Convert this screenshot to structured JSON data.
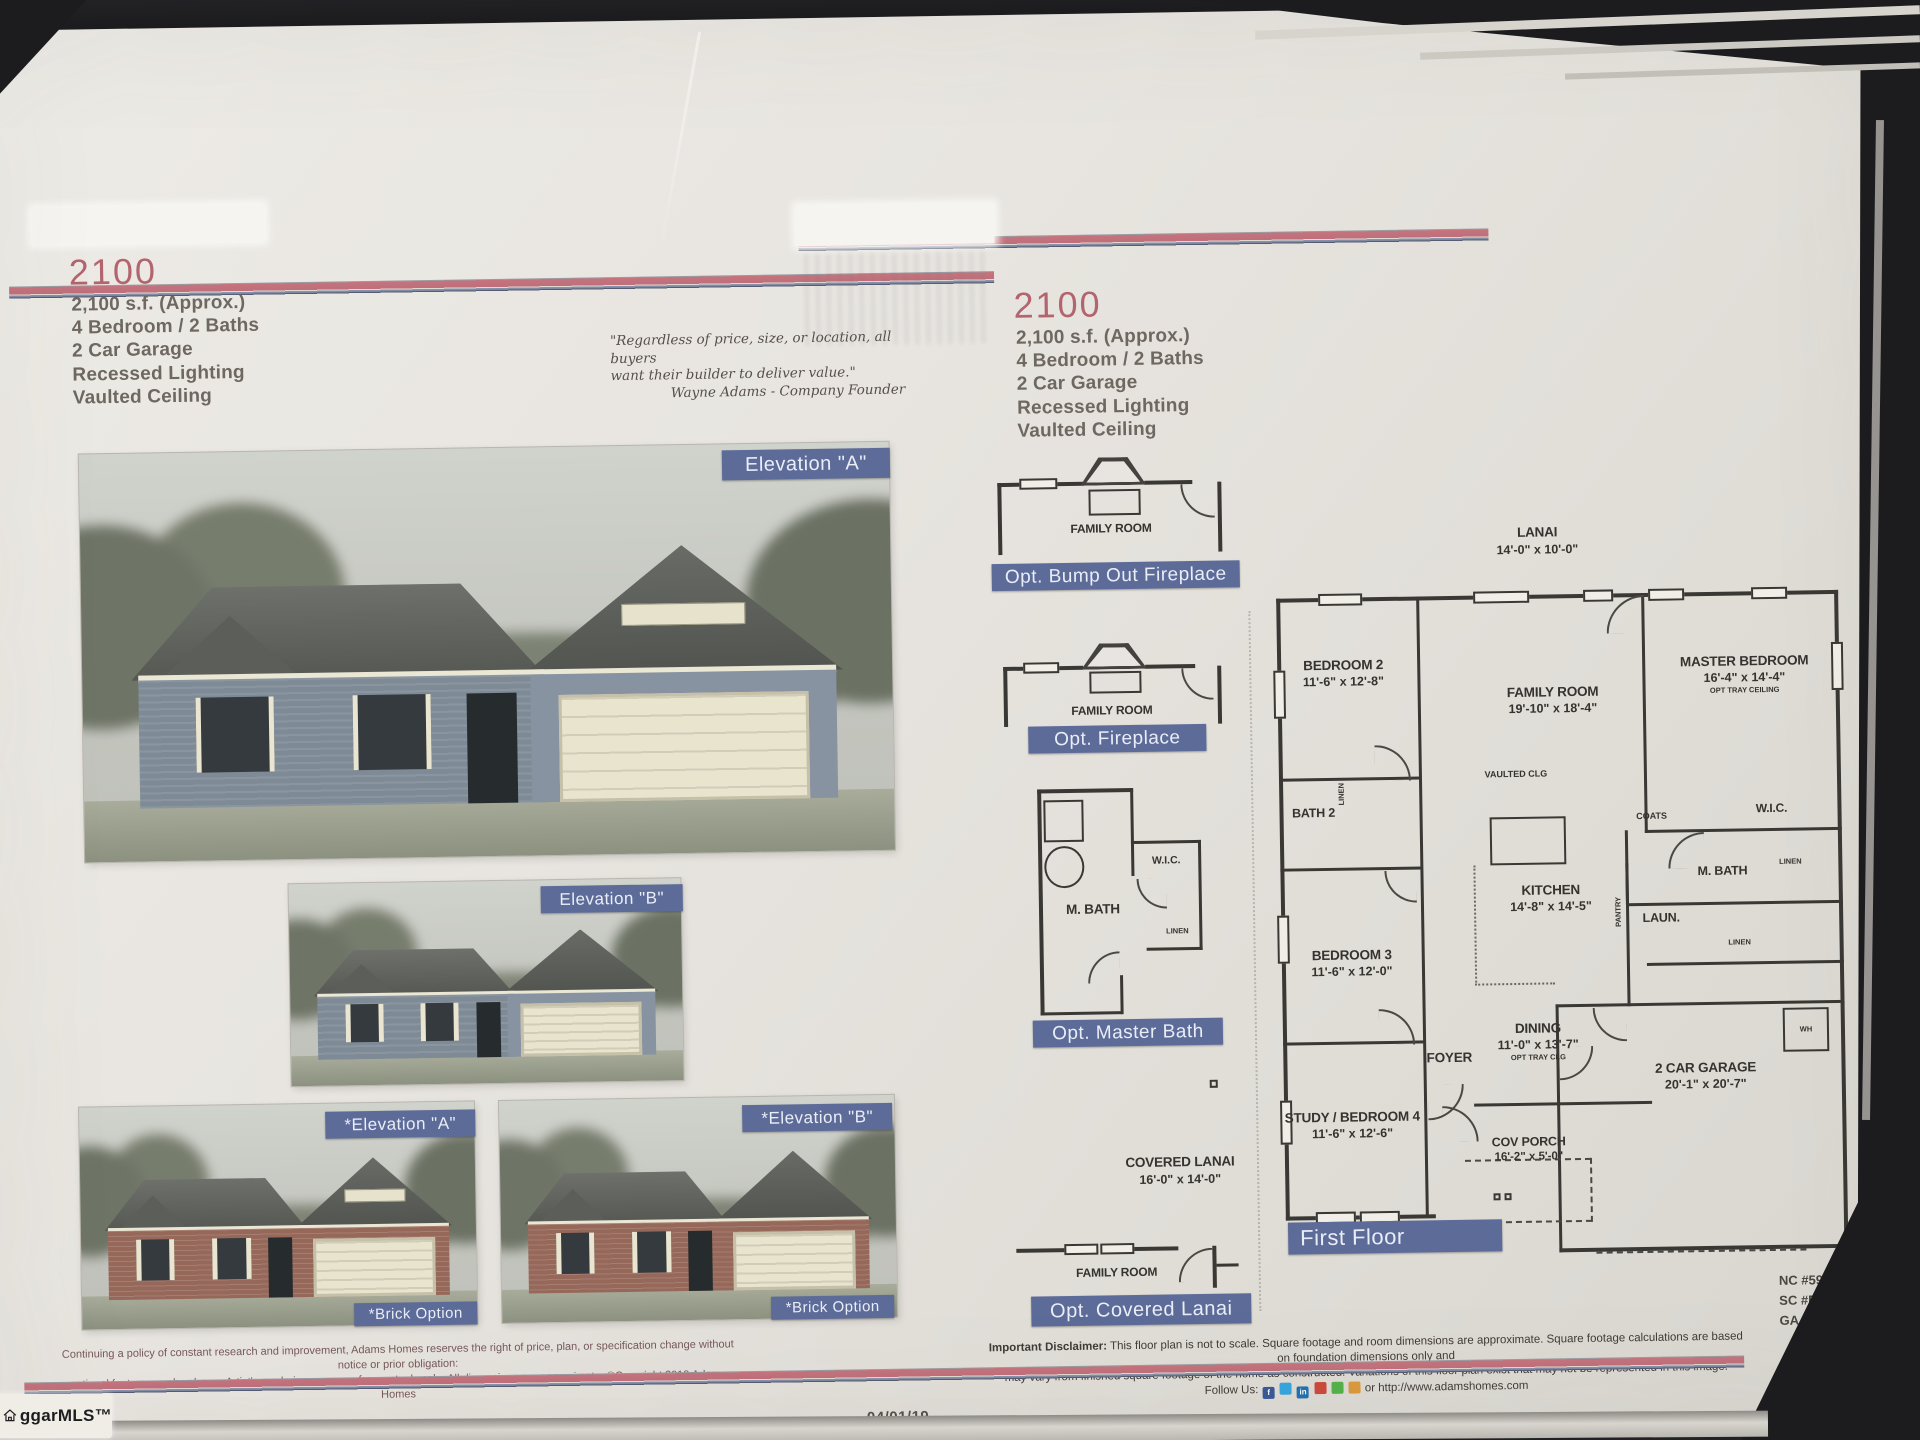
{
  "photo": {
    "watermark": "ggarMLS™",
    "date_center": "04/01/19",
    "date_right": "04/01/19"
  },
  "model": "2100",
  "specs": [
    "2,100 s.f. (Approx.)",
    "4 Bedroom / 2 Baths",
    "2 Car Garage",
    "Recessed Lighting",
    "Vaulted Ceiling"
  ],
  "quote": {
    "line1": "\"Regardless of price, size, or location, all buyers",
    "line2": "want their builder to deliver value.\"",
    "attrib": "Wayne Adams - Company Founder"
  },
  "elevations": {
    "a": "Elevation \"A\"",
    "b": "Elevation \"B\"",
    "a_brick": "*Elevation \"A\"",
    "b_brick": "*Elevation \"B\"",
    "brick_caption": "*Brick Option"
  },
  "options": {
    "bump_room": "FAMILY ROOM",
    "bump_label": "Opt. Bump Out Fireplace",
    "fp_room": "FAMILY ROOM",
    "fp_label": "Opt. Fireplace",
    "mb_wic": "W.I.C.",
    "mb_bath": "M. BATH",
    "mb_linen": "LINEN",
    "mb_label": "Opt. Master Bath",
    "cl_name": "COVERED LANAI",
    "cl_dims": "16'-0\" x 14'-0\"",
    "cl_room": "FAMILY ROOM",
    "cl_label": "Opt. Covered Lanai"
  },
  "plan": {
    "banner": "First Floor",
    "lanai": "LANAI",
    "lanai_dims": "14'-0\" x 10'-0\"",
    "bedroom2": "BEDROOM 2",
    "bedroom2_dims": "11'-6\" x 12'-8\"",
    "family": "FAMILY ROOM",
    "family_dims": "19'-10\" x 18'-4\"",
    "vaulted": "VAULTED CLG",
    "master": "MASTER BEDROOM",
    "master_dims": "16'-4\" x 14'-4\"",
    "master_note": "OPT TRAY CEILING",
    "bath2": "BATH 2",
    "linen": "LINEN",
    "wic": "W.I.C.",
    "coats": "COATS",
    "mbath": "M. BATH",
    "kitchen": "KITCHEN",
    "kitchen_dims": "14'-8\" x 14'-5\"",
    "pantry": "PANTRY",
    "laun": "LAUN.",
    "bedroom3": "BEDROOM 3",
    "bedroom3_dims": "11'-6\" x 12'-0\"",
    "dining": "DINING",
    "dining_dims": "11'-0\" x 13'-7\"",
    "dining_note": "OPT TRAY CLG",
    "foyer": "FOYER",
    "study": "STUDY / BEDROOM 4",
    "study_dims": "11'-6\" x 12'-6\"",
    "covporch": "COV PORCH",
    "covporch_dims": "16'-2\" x 5'-0\"",
    "garage": "2 CAR GARAGE",
    "garage_dims": "20'-1\" x 20'-7\"",
    "wh": "WH"
  },
  "footer": {
    "licenses": [
      "NC #597B5",
      "SC #RBB.22464",
      "GA #RBQA005711"
    ],
    "disclaimer_bold": "Important Disclaimer:",
    "disclaimer_l1": "This floor plan is not to scale. Square footage and room dimensions are approximate. Square footage calculations are based on foundation dimensions only and",
    "disclaimer_l2": "may vary from finished square footage of the home as constructed. Variations of this floor plan exist that may not be represented in this image.",
    "follow": "Follow Us:",
    "url": "or http://www.adamshomes.com",
    "fine1": "Continuing a policy of constant research and improvement, Adams Homes reserves the right of price, plan, or specification change without notice or prior obligation:",
    "fine2": "optional feature may be shown. Artist's rendering may vary from actual scale. All dimensions are approximate. ©Copyright 2019 Adams Homes",
    "social_glyphs": [
      "f",
      "",
      "in",
      "",
      "",
      ""
    ],
    "social_styles": [
      "background:#3b5998",
      "background:#36a5dd",
      "background:#2471af",
      "background:#cd4a3d",
      "background:#56b24a",
      "background:#dd9a3e"
    ]
  },
  "colors": {
    "banner_blue": "#5d6b99",
    "stripe_red": "#c4737c",
    "stripe_blue": "#8d97b0",
    "model_pink": "#b2656f"
  }
}
